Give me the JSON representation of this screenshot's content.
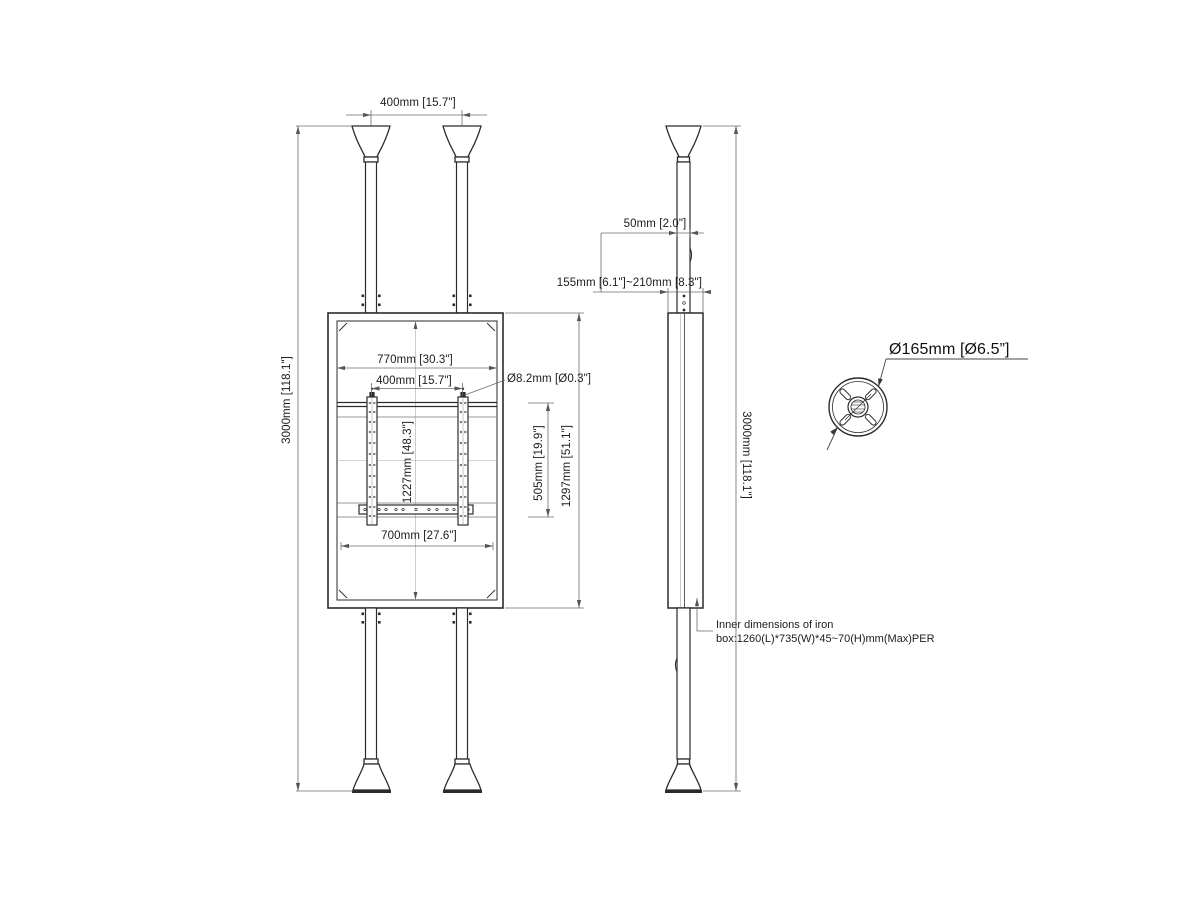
{
  "title": "Floor-to-ceiling display mount technical drawing",
  "labels": {
    "top_pole_spacing": "400mm [15.7\"]",
    "overall_height_left": "3000mm [118.1\"]",
    "panel_inner_width": "770mm [30.3\"]",
    "bracket_spacing": "400mm [15.7\"]",
    "hole_diameter": "Ø8.2mm [Ø0.3\"]",
    "panel_inner_height": "1227mm [48.3\"]",
    "bracket_height": "505mm [19.9\"]",
    "panel_height": "1297mm [51.1\"]",
    "panel_bottom_width": "700mm [27.6\"]",
    "pole_depth": "50mm [2.0\"]",
    "box_depth_range": "155mm [6.1\"]~210mm [8.3\"]",
    "overall_height_right": "3000mm [118.1\"]",
    "flange_diameter": "Ø165mm [Ø6.5”]"
  },
  "note": {
    "line1": "Inner dimensions of iron",
    "line2": "box:1260(L)*735(W)*45~70(H)mm(Max)PER"
  }
}
